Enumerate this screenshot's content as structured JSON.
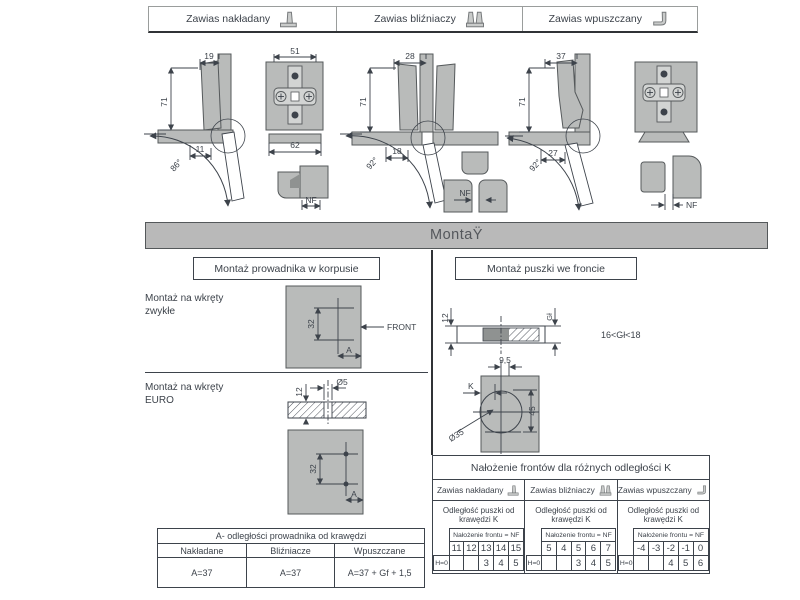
{
  "header_tabs": {
    "items": [
      {
        "label": "Zawias nakładany"
      },
      {
        "label": "Zawias bliźniaczy"
      },
      {
        "label": "Zawias wpuszczany"
      }
    ]
  },
  "montaz_bar": {
    "title": "MontaŸ"
  },
  "hinge_diagrams": {
    "overlay": {
      "top_width": "19",
      "height": "71",
      "bottom_offset": "11",
      "angle": "86°",
      "plate_width": "51",
      "plate_base_width": "62",
      "nf_label": "NF"
    },
    "twin": {
      "top_width": "28",
      "height": "71",
      "bottom_offset": "18",
      "angle": "92°",
      "nf_label": "NF"
    },
    "inset": {
      "top_width": "37",
      "height": "71",
      "bottom_offset": "27",
      "angle": "92°",
      "nf_label": "NF"
    }
  },
  "sections": {
    "left_title": "Montaż prowadnika w korpusie",
    "right_title": "Montaż puszki we froncie"
  },
  "guide_mounting": {
    "normal_label": "Montaż na wkręty zwykłe",
    "euro_label": "Montaż na wkręty EURO",
    "front_label": "FRONT",
    "dim_spacing": "32",
    "dim_a": "A",
    "euro_depth": "12",
    "euro_diameter": "Ø5"
  },
  "cup_mounting": {
    "front_thickness": "12",
    "depth_label": "Gł",
    "depth_range": "16<Gł<18",
    "dim_9_5": "9,5",
    "dim_k": "K",
    "dim_45": "45",
    "cup_diameter": "Ø35"
  },
  "table_a": {
    "title": "A- odległości prowadnika od krawędzi",
    "columns": [
      "Nakładane",
      "Bliźniacze",
      "Wpuszczane"
    ],
    "values": [
      "A=37",
      "A=37",
      "A=37 + Gf + 1,5"
    ]
  },
  "table_nf": {
    "title": "Nałożenie frontów dla różnych odległości K",
    "nf_header": "Nałożenie frontu = NF",
    "subtitle": "Odległość puszki od krawędzi K",
    "columns": [
      {
        "hinge": "Zawias nakładany",
        "k": [
          "11",
          "12",
          "13",
          "14",
          "15"
        ],
        "h": "H=0",
        "nf": [
          "",
          "",
          "3",
          "4",
          "5"
        ]
      },
      {
        "hinge": "Zawias bliźniaczy",
        "k": [
          "5",
          "4",
          "5",
          "6",
          "7"
        ],
        "h": "H=0",
        "nf": [
          "",
          "",
          "3",
          "4",
          "5"
        ]
      },
      {
        "hinge": "Zawias wpuszczany",
        "k": [
          "-4",
          "-3",
          "-2",
          "-1",
          "0"
        ],
        "h": "H=0",
        "nf": [
          "",
          "",
          "4",
          "5",
          "6"
        ]
      }
    ]
  }
}
